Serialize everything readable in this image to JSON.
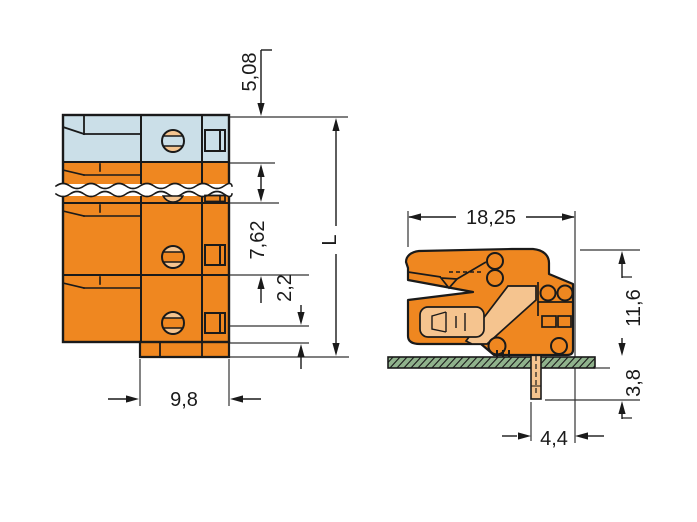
{
  "drawing": {
    "kind": "connector dimensional drawing",
    "front_view": {
      "name": "front view with break lines",
      "dims": {
        "top_to_first_pole": "5,08",
        "pole_pitch": "7,62",
        "foot_height": "2,2",
        "overall_length": "L",
        "foot_width": "9,8"
      }
    },
    "side_view": {
      "name": "side view on printed circuit board",
      "dims": {
        "depth": "18,25",
        "height_above_board": "11,6",
        "pin_length_below_board": "3,8",
        "pin_to_front_edge": "4,4"
      }
    },
    "colors": {
      "housing_orange": "#EF8720",
      "contact_peach": "#F5C48F",
      "first_pole_blue": "#CBDFE8",
      "pcb_green": "#8FB28C",
      "line": "#1A1A1A"
    }
  }
}
